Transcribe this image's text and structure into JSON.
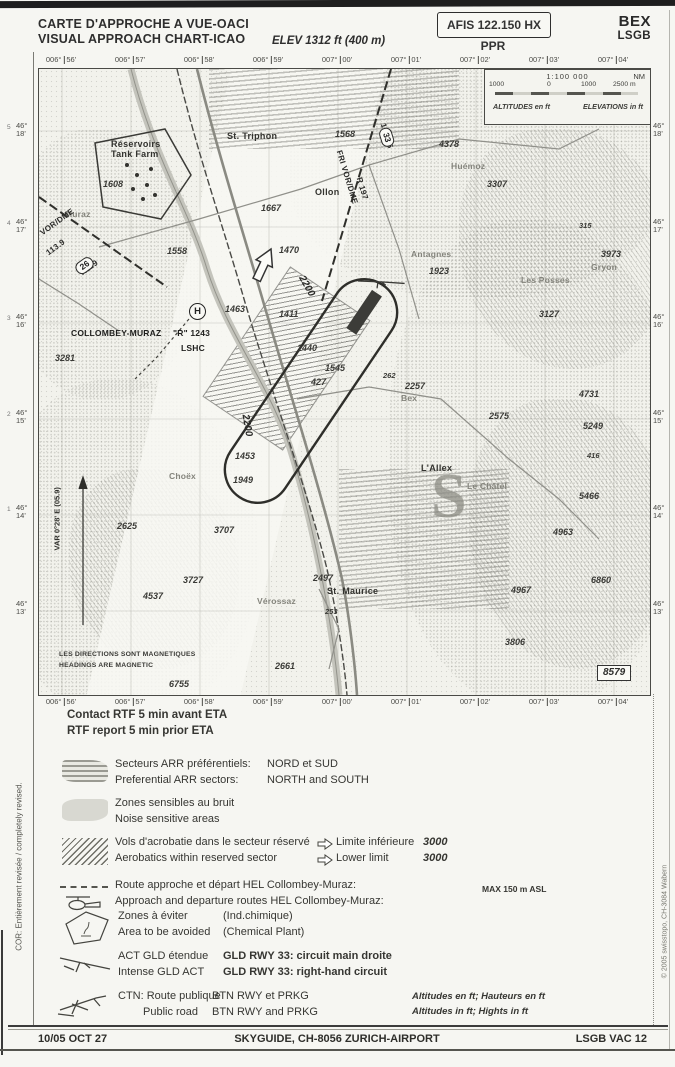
{
  "header": {
    "title_fr": "CARTE D'APPROCHE A VUE-OACI",
    "title_en": "VISUAL APPROACH CHART-ICAO",
    "elevation": "ELEV 1312 ft (400 m)",
    "afis": "AFIS 122.150 HX",
    "ppr": "PPR",
    "icao_code": "BEX",
    "icao_id": "LSGB"
  },
  "grid": {
    "lon": [
      "006°|56'",
      "006°|57'",
      "006°|58'",
      "006°|59'",
      "007°|00'",
      "007°|01'",
      "007°|02'",
      "007°|03'",
      "007°|04'"
    ],
    "lat_deg": "46°",
    "lat_min": [
      "18'",
      "17'",
      "16'",
      "15'",
      "14'",
      "13'"
    ],
    "lat_idx": [
      "5",
      "4",
      "3",
      "2",
      "1",
      ""
    ]
  },
  "scalebox": {
    "scale": "1:100 000",
    "nm": "NM",
    "bar_labels": [
      "1000",
      "0",
      "1000",
      "2500 m"
    ],
    "alt": "ALTITUDES en ft",
    "elev": "ELEVATIONS in ft"
  },
  "map": {
    "helipad": "H",
    "frame_number": "8579",
    "badges": [
      {
        "t": "26",
        "x": 36,
        "y": 190,
        "r": -36
      },
      {
        "t": "33",
        "x": 338,
        "y": 62,
        "r": 73
      }
    ],
    "labels": [
      {
        "t": "Réservoirs",
        "x": 72,
        "y": 70,
        "c": "town s"
      },
      {
        "t": "Tank Farm",
        "x": 72,
        "y": 80,
        "c": "town s"
      },
      {
        "t": "1608",
        "x": 64,
        "y": 110,
        "c": "elevl"
      },
      {
        "t": "St. Triphon",
        "x": 188,
        "y": 62,
        "c": "town"
      },
      {
        "t": "1568",
        "x": 296,
        "y": 60,
        "c": "elevl"
      },
      {
        "t": "Ollon",
        "x": 276,
        "y": 118,
        "c": "town"
      },
      {
        "t": "1667",
        "x": 222,
        "y": 134,
        "c": "elevl"
      },
      {
        "t": "Muraz",
        "x": 26,
        "y": 140,
        "c": "name"
      },
      {
        "t": "VOR/DME",
        "x": 2,
        "y": 160,
        "c": "vor",
        "r": -36
      },
      {
        "t": "113.9",
        "x": 8,
        "y": 180,
        "c": "vor",
        "r": -36
      },
      {
        "t": "R119",
        "x": 42,
        "y": 200,
        "c": "vor",
        "r": -36
      },
      {
        "t": "FRI VOR/DME",
        "x": 300,
        "y": 77,
        "c": "vor",
        "r": 73
      },
      {
        "t": "R 197",
        "x": 320,
        "y": 104,
        "c": "vor",
        "r": 73
      },
      {
        "t": "110.85",
        "x": 344,
        "y": 50,
        "c": "vor",
        "r": 73
      },
      {
        "t": "4378",
        "x": 400,
        "y": 70,
        "c": "elevl"
      },
      {
        "t": "Huémoz",
        "x": 412,
        "y": 92,
        "c": "name"
      },
      {
        "t": "3307",
        "x": 448,
        "y": 110,
        "c": "elevl"
      },
      {
        "t": "315",
        "x": 540,
        "y": 152,
        "c": "elevl s"
      },
      {
        "t": "Antagnes",
        "x": 372,
        "y": 180,
        "c": "name"
      },
      {
        "t": "1923",
        "x": 390,
        "y": 197,
        "c": "elevl"
      },
      {
        "t": "Les Posses",
        "x": 482,
        "y": 206,
        "c": "name"
      },
      {
        "t": "3127",
        "x": 500,
        "y": 240,
        "c": "elevl"
      },
      {
        "t": "3973",
        "x": 562,
        "y": 180,
        "c": "elevl"
      },
      {
        "t": "Gryon",
        "x": 552,
        "y": 193,
        "c": "name"
      },
      {
        "t": "1470",
        "x": 240,
        "y": 176,
        "c": "elevl"
      },
      {
        "t": "1558",
        "x": 128,
        "y": 177,
        "c": "elevl"
      },
      {
        "t": "2200",
        "x": 262,
        "y": 202,
        "c": "circ",
        "r": 60
      },
      {
        "t": "2200",
        "x": 206,
        "y": 340,
        "c": "circ",
        "r": 80
      },
      {
        "t": "1463",
        "x": 186,
        "y": 235,
        "c": "elevl"
      },
      {
        "t": "1411",
        "x": 240,
        "y": 240,
        "c": "elevl"
      },
      {
        "t": "1440",
        "x": 258,
        "y": 274,
        "c": "elevl"
      },
      {
        "t": "1545",
        "x": 286,
        "y": 294,
        "c": "elevl"
      },
      {
        "t": "427",
        "x": 272,
        "y": 308,
        "c": "elevl"
      },
      {
        "t": "262",
        "x": 344,
        "y": 302,
        "c": "elevl s"
      },
      {
        "t": "COLLOMBEY-MURAZ",
        "x": 32,
        "y": 259,
        "c": "apt"
      },
      {
        "t": "\"R\" 1243",
        "x": 134,
        "y": 259,
        "c": "apt"
      },
      {
        "t": "LSHC",
        "x": 142,
        "y": 274,
        "c": "apt"
      },
      {
        "t": "3281",
        "x": 16,
        "y": 284,
        "c": "elevl"
      },
      {
        "t": "2257",
        "x": 366,
        "y": 312,
        "c": "elevl"
      },
      {
        "t": "Bex",
        "x": 362,
        "y": 324,
        "c": "name"
      },
      {
        "t": "2575",
        "x": 450,
        "y": 342,
        "c": "elevl"
      },
      {
        "t": "4731",
        "x": 540,
        "y": 320,
        "c": "elevl"
      },
      {
        "t": "5249",
        "x": 544,
        "y": 352,
        "c": "elevl"
      },
      {
        "t": "416",
        "x": 548,
        "y": 382,
        "c": "elevl s"
      },
      {
        "t": "L'Allex",
        "x": 382,
        "y": 394,
        "c": "town"
      },
      {
        "t": "Le Châtel",
        "x": 428,
        "y": 412,
        "c": "name"
      },
      {
        "t": "5466",
        "x": 540,
        "y": 422,
        "c": "elevl"
      },
      {
        "t": "4963",
        "x": 514,
        "y": 458,
        "c": "elevl"
      },
      {
        "t": "6860",
        "x": 552,
        "y": 506,
        "c": "elevl"
      },
      {
        "t": "4967",
        "x": 472,
        "y": 516,
        "c": "elevl"
      },
      {
        "t": "3806",
        "x": 466,
        "y": 568,
        "c": "elevl"
      },
      {
        "t": "1453",
        "x": 196,
        "y": 382,
        "c": "elevl"
      },
      {
        "t": "Choëx",
        "x": 130,
        "y": 402,
        "c": "name"
      },
      {
        "t": "1949",
        "x": 194,
        "y": 406,
        "c": "elevl"
      },
      {
        "t": "2625",
        "x": 78,
        "y": 452,
        "c": "elevl"
      },
      {
        "t": "3707",
        "x": 175,
        "y": 456,
        "c": "elevl"
      },
      {
        "t": "3727",
        "x": 144,
        "y": 506,
        "c": "elevl"
      },
      {
        "t": "4537",
        "x": 104,
        "y": 522,
        "c": "elevl"
      },
      {
        "t": "2497",
        "x": 274,
        "y": 504,
        "c": "elevl"
      },
      {
        "t": "St. Maurice",
        "x": 288,
        "y": 517,
        "c": "town"
      },
      {
        "t": "253",
        "x": 286,
        "y": 538,
        "c": "elevl s"
      },
      {
        "t": "Vérossaz",
        "x": 218,
        "y": 527,
        "c": "name"
      },
      {
        "t": "2661",
        "x": 236,
        "y": 592,
        "c": "elevl"
      },
      {
        "t": "6755",
        "x": 130,
        "y": 610,
        "c": "elevl"
      },
      {
        "t": "VAR 0°28' E (05.9)",
        "x": 18,
        "y": 477,
        "c": "varl",
        "r": -90
      },
      {
        "t": "LES DIRECTIONS SONT MAGNETIQUES",
        "x": 20,
        "y": 582,
        "c": "notel"
      },
      {
        "t": "HEADINGS ARE MAGNETIC",
        "x": 20,
        "y": 593,
        "c": "notel"
      },
      {
        "t": "S",
        "x": 392,
        "y": 390,
        "c": "sector"
      }
    ]
  },
  "legend": {
    "contact_fr": "Contact RTF 5 min avant ETA",
    "contact_en": "RTF report 5 min prior ETA",
    "r1": {
      "fr": "Secteurs ARR préférentiels:",
      "en": "Preferential ARR sectors:",
      "val_fr": "NORD et SUD",
      "val_en": "NORTH and SOUTH"
    },
    "r2": {
      "fr": "Zones sensibles au bruit",
      "en": "Noise sensitive areas"
    },
    "r3": {
      "fr": "Vols d'acrobatie dans le secteur réservé",
      "en": "Aerobatics within reserved sector",
      "lim_fr": "Limite inférieure",
      "lim_en": "Lower limit",
      "val": "3000"
    },
    "r4": {
      "fr": "Route approche et départ HEL Collombey-Muraz:",
      "en": "Approach and departure routes HEL Collombey-Muraz:",
      "right": "MAX 150 m ASL"
    },
    "r5": {
      "fr": "Zones à éviter",
      "en": "Area to be avoided",
      "val_fr": "(Ind.chimique)",
      "val_en": "(Chemical Plant)"
    },
    "r6": {
      "fr": "ACT GLD étendue",
      "en": "Intense GLD ACT",
      "val_fr": "GLD RWY 33: circuit main droite",
      "val_en": "GLD RWY 33: right-hand circuit"
    },
    "r7": {
      "fr": "CTN: Route publique",
      "en": "Public road",
      "val_fr": "BTN RWY et PRKG",
      "val_en": "BTN RWY and PRKG",
      "right_fr": "Altitudes en ft; Hauteurs en ft",
      "right_en": "Altitudes in ft; Hights in ft"
    }
  },
  "footer": {
    "date": "10/05 OCT 27",
    "publisher": "SKYGUIDE, CH-8056 ZURICH-AIRPORT",
    "doc": "LSGB VAC 12"
  },
  "side": {
    "left": "COR: Entièrement revisée / completely revised.",
    "right": "© 2005 swisstopo, CH-3084 Wabern"
  }
}
